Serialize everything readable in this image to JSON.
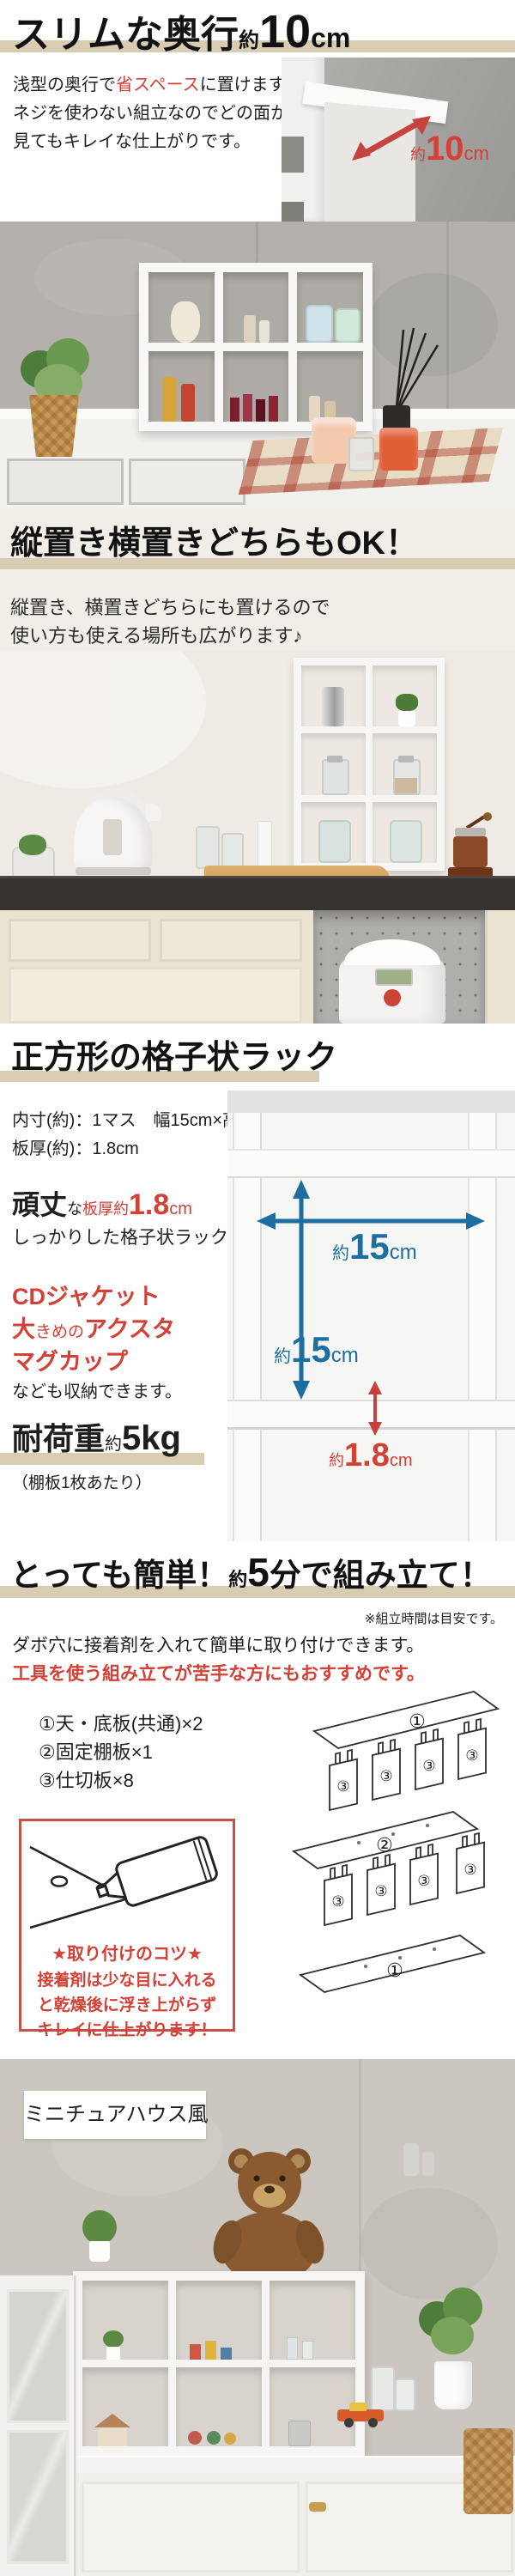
{
  "colors": {
    "bar_tan": "#d8cdb2",
    "accent_red": "#d24036",
    "accent_blue": "#1c6da0",
    "section2_bg": "#f1eee8"
  },
  "s1": {
    "h_main": "スリムな奥行",
    "h_approx": "約",
    "h_num": "10",
    "h_unit": "cm",
    "p1a": "浅型の奥行で",
    "p1b": "省スペース",
    "p1c": "に置けます。",
    "p2": "ネジを使わない組立なのでどの面から",
    "p3": "見てもキレイな仕上がりです。",
    "photo_approx": "約",
    "photo_num": "10",
    "photo_unit": "cm"
  },
  "s2": {
    "heading": "縦置き横置きどちらもOK！",
    "p1": "縦置き、横置きどちらにも置けるので",
    "p2": "使い方も使える場所も広がります♪"
  },
  "s3": {
    "heading": "正方形の格子状ラック",
    "spec1": "内寸(約)：1マス　幅15cm×高さ15cm",
    "spec2": "板厚(約)：1.8cm",
    "sturdy_big": "頑丈",
    "sturdy_small": "な",
    "sturdy_red": "板厚約",
    "sturdy_num": "1.8",
    "sturdy_unit": "cm",
    "sturdy_sub": "しっかりした格子状ラック",
    "item1": "CDジャケット",
    "item2a": "大",
    "item2b": "きめの",
    "item2c": "アクスタ",
    "item3": "マグカップ",
    "items_note": "なども収納できます。",
    "load_big": "耐荷重",
    "load_small": "約",
    "load_num": "5kg",
    "load_note": "（棚板1枚あたり）",
    "dim_approx": "約",
    "dim_w": "15",
    "dim_h": "15",
    "dim_unit": "cm",
    "thick_approx": "約",
    "thick_num": "1.8",
    "thick_unit": "cm"
  },
  "s4": {
    "h_pre": "とっても簡単！",
    "h_approx": "約",
    "h_num": "5",
    "h_post": "分で組み立て！",
    "note": "※組立時間は目安です。",
    "p1": "ダボ穴に接着剤を入れて簡単に取り付けできます。",
    "p2": "工具を使う組み立てが苦手な方にもおすすめです。",
    "part1": "①天・底板(共通)×2",
    "part2": "②固定棚板×1",
    "part3": "③仕切板×8",
    "tip_title": "★取り付けのコツ★",
    "tip1": "接着剤は少な目に入れる",
    "tip2": "と乾燥後に浮き上がらず",
    "tip3": "キレイに仕上がります！",
    "lab1": "①",
    "lab2": "②",
    "lab3": "③"
  },
  "s5": {
    "label": "ミニチュアハウス風"
  }
}
